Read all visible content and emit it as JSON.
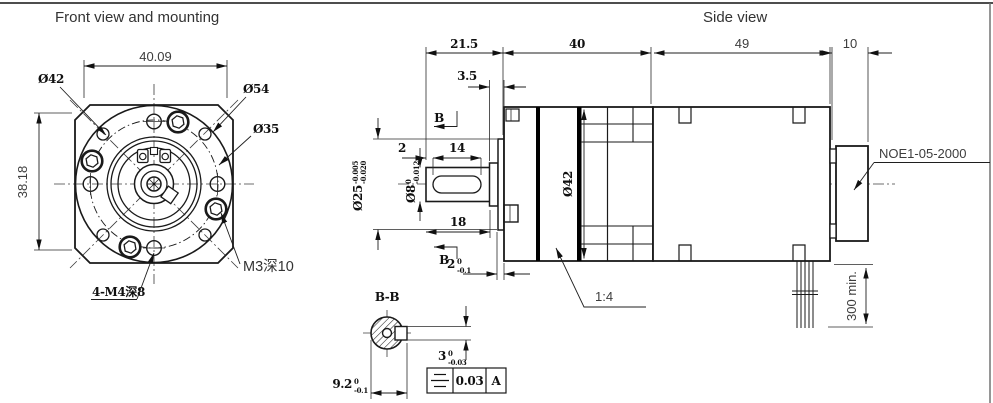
{
  "titles": {
    "front_view": "Front view and mounting",
    "side_view": "Side view"
  },
  "front_view": {
    "dim_width": "40.09",
    "dim_height": "38.18",
    "label_body_dia": "Ø42",
    "label_corner_dia": "Ø54",
    "label_bolt_circle_dia": "Ø35",
    "label_mount_holes": "4-M4深8",
    "label_thread_note": "M3深10"
  },
  "side_view": {
    "dim_shaft_length": "21.5",
    "dim_boss_length": "3.5",
    "dim_gearbox_length": "40",
    "dim_motor_length": "49",
    "dim_encoder_length": "10",
    "dim_key_offset": "2",
    "dim_key_length": "14",
    "dim_shaft_ext": "18",
    "label_body_dia": "Ø42",
    "shaft_dia": {
      "main": "Ø8",
      "upper": "0",
      "lower": "-0.012"
    },
    "boss_dia": {
      "main": "Ø25",
      "upper": "-0.005",
      "lower": "-0.020"
    },
    "boss_thickness": {
      "main": "2",
      "upper": "0",
      "lower": "-0.1"
    },
    "scale_label": "1:4",
    "encoder_label": "NOE1-05-2000",
    "cable_length": "300 min.",
    "section_letter": "B"
  },
  "section_view": {
    "title": "B-B",
    "key_width": {
      "main": "3",
      "upper": "0",
      "lower": "-0.03"
    },
    "shaft_key_height": {
      "main": "9.2",
      "upper": "0",
      "lower": "-0.1"
    },
    "fcf": {
      "tolerance": "0.03",
      "datum": "A"
    }
  },
  "colors": {
    "line": "#1a1a1a",
    "label_text": "#3d3d3d",
    "background": "#ffffff"
  }
}
